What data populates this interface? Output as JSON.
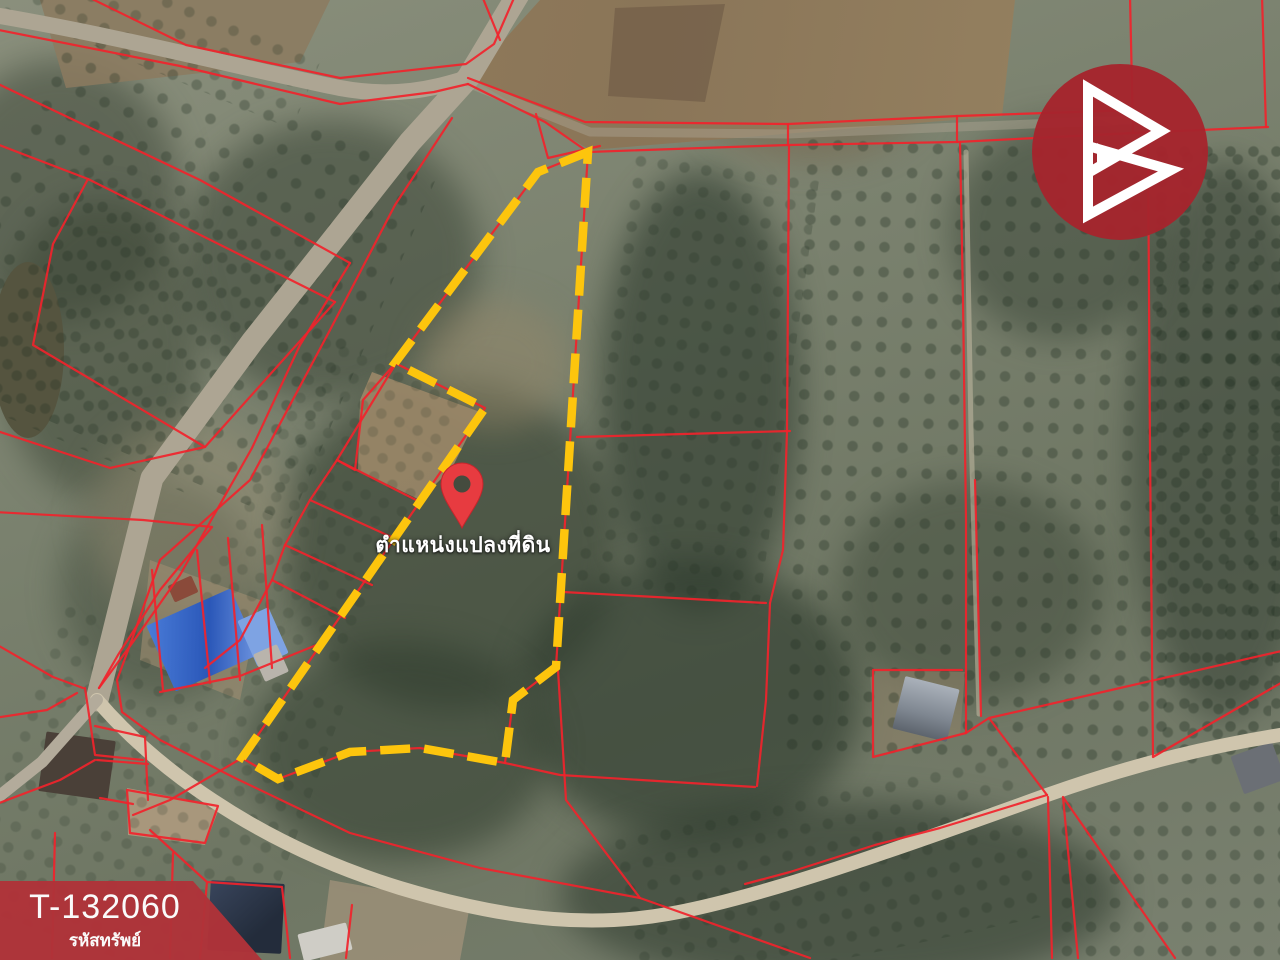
{
  "map": {
    "pin_label": "ตำแหน่งแปลงที่ดิน",
    "plot_boundary_style": "yellow-dashed",
    "parcel_line_style": "red-solid"
  },
  "banner": {
    "property_code": "T-132060",
    "caption": "รหัสทรัพย์"
  },
  "logo": {
    "icon": "double-triangle-b-logo",
    "shape": "red-circle"
  },
  "colors": {
    "parcel_red": "#f1232b",
    "plot_yellow": "#fdc50d",
    "banner_red": "#b03339",
    "logo_red": "#a5242d",
    "pin_red": "#e73b40",
    "text_white": "#ffffff"
  }
}
